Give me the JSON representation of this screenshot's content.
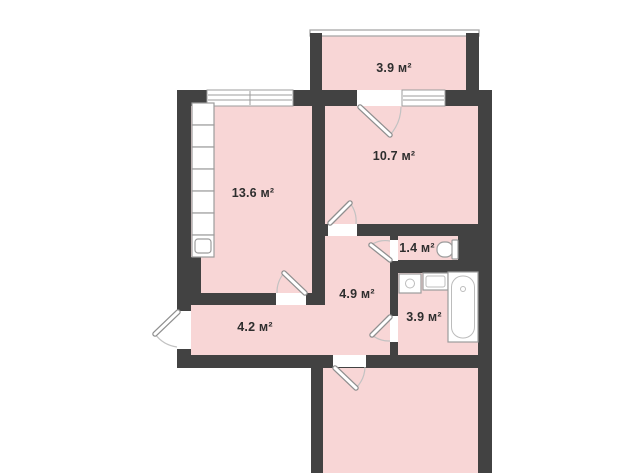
{
  "floor_plan": {
    "unit": "м²",
    "rooms": [
      {
        "name": "balcony",
        "area_label": "3.9 м²"
      },
      {
        "name": "kitchen-living-room",
        "area_label": "13.6 м²"
      },
      {
        "name": "bedroom",
        "area_label": "10.7 м²"
      },
      {
        "name": "wc",
        "area_label": "1.4 м²"
      },
      {
        "name": "hallway",
        "area_label": "4.9 м²"
      },
      {
        "name": "bathroom",
        "area_label": "3.9 м²"
      },
      {
        "name": "entry-corridor",
        "area_label": "4.2 м²"
      },
      {
        "name": "lower-room"
      }
    ],
    "fixtures": [
      "kitchen-cabinets",
      "kitchen-sink",
      "toilet",
      "washing-machine",
      "bathroom-sink",
      "bathtub"
    ],
    "colors": {
      "wall": "#424242",
      "room_fill": "#f8d6d6",
      "fixture_fill": "#ffffff",
      "fixture_outline": "#9c9c9c",
      "label_text": "#2e2e2e",
      "background": "#ffffff"
    }
  }
}
